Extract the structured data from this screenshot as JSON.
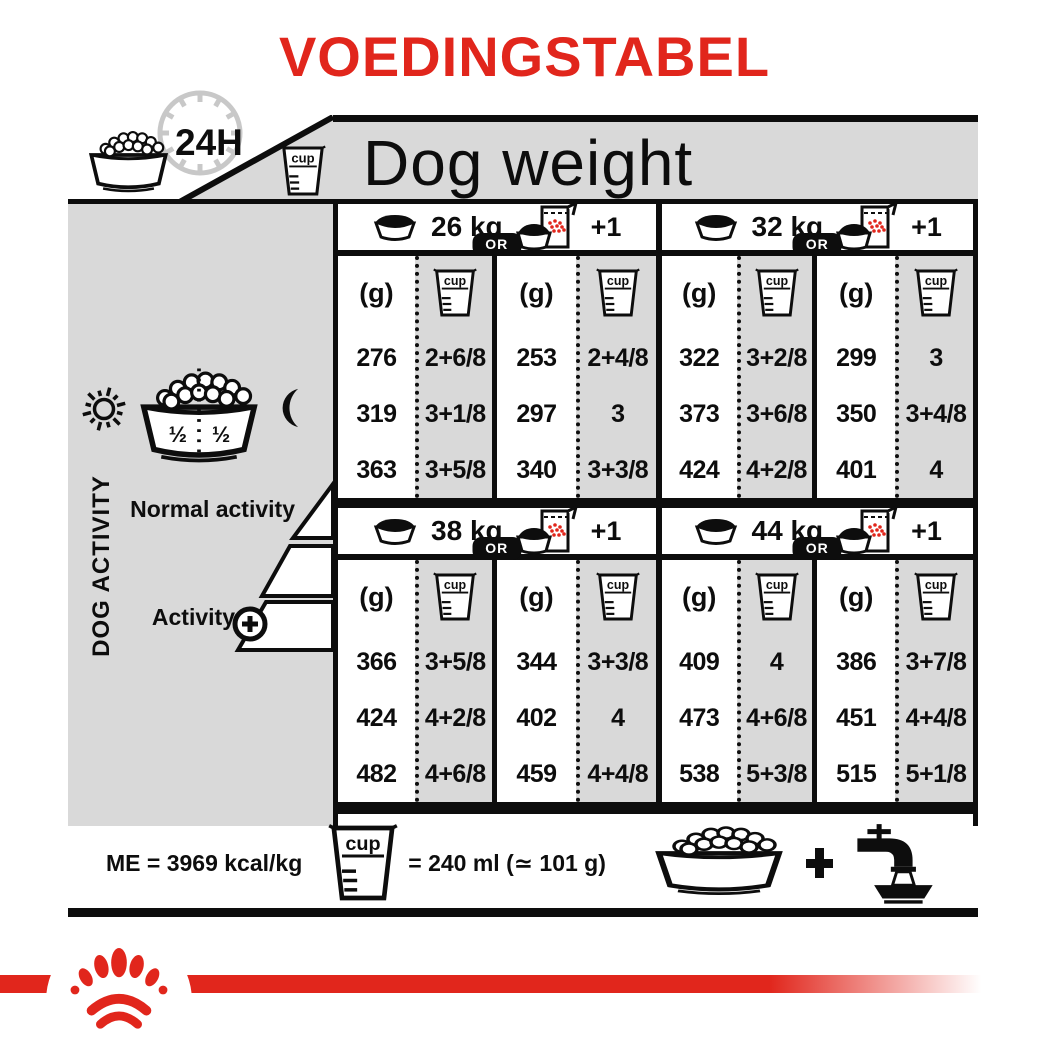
{
  "title": "VOEDINGSTABEL",
  "colors": {
    "red": "#e1261c",
    "panel_gray": "#d9d9d9",
    "ink": "#0d0d0d"
  },
  "header": {
    "clock_label": "24H",
    "dog_weight_label": "Dog weight"
  },
  "sidebar": {
    "vertical_label": "DOG ACTIVITY",
    "half_left": "½",
    "half_right": "½",
    "normal_activity_label": "Normal activity",
    "activity_label": "Activity"
  },
  "table": {
    "or_label": "OR",
    "plus_one_label": "+1",
    "grams_header": "(g)",
    "cup_header": "cup",
    "sections": [
      {
        "weight": "26 kg",
        "dry": {
          "g": [
            "276",
            "319",
            "363"
          ],
          "cup": [
            "2+6/8",
            "3+1/8",
            "3+5/8"
          ]
        },
        "wet": {
          "g": [
            "253",
            "297",
            "340"
          ],
          "cup": [
            "2+4/8",
            "3",
            "3+3/8"
          ]
        }
      },
      {
        "weight": "32 kg",
        "dry": {
          "g": [
            "322",
            "373",
            "424"
          ],
          "cup": [
            "3+2/8",
            "3+6/8",
            "4+2/8"
          ]
        },
        "wet": {
          "g": [
            "299",
            "350",
            "401"
          ],
          "cup": [
            "3",
            "3+4/8",
            "4"
          ]
        }
      },
      {
        "weight": "38 kg",
        "dry": {
          "g": [
            "366",
            "424",
            "482"
          ],
          "cup": [
            "3+5/8",
            "4+2/8",
            "4+6/8"
          ]
        },
        "wet": {
          "g": [
            "344",
            "402",
            "459"
          ],
          "cup": [
            "3+3/8",
            "4",
            "4+4/8"
          ]
        }
      },
      {
        "weight": "44 kg",
        "dry": {
          "g": [
            "409",
            "473",
            "538"
          ],
          "cup": [
            "4",
            "4+6/8",
            "5+3/8"
          ]
        },
        "wet": {
          "g": [
            "386",
            "451",
            "515"
          ],
          "cup": [
            "3+7/8",
            "4+4/8",
            "5+1/8"
          ]
        }
      }
    ]
  },
  "footer": {
    "me_label": "ME = 3969 kcal/kg",
    "cup_equiv_label": "= 240 ml (≃ 101 g)"
  }
}
